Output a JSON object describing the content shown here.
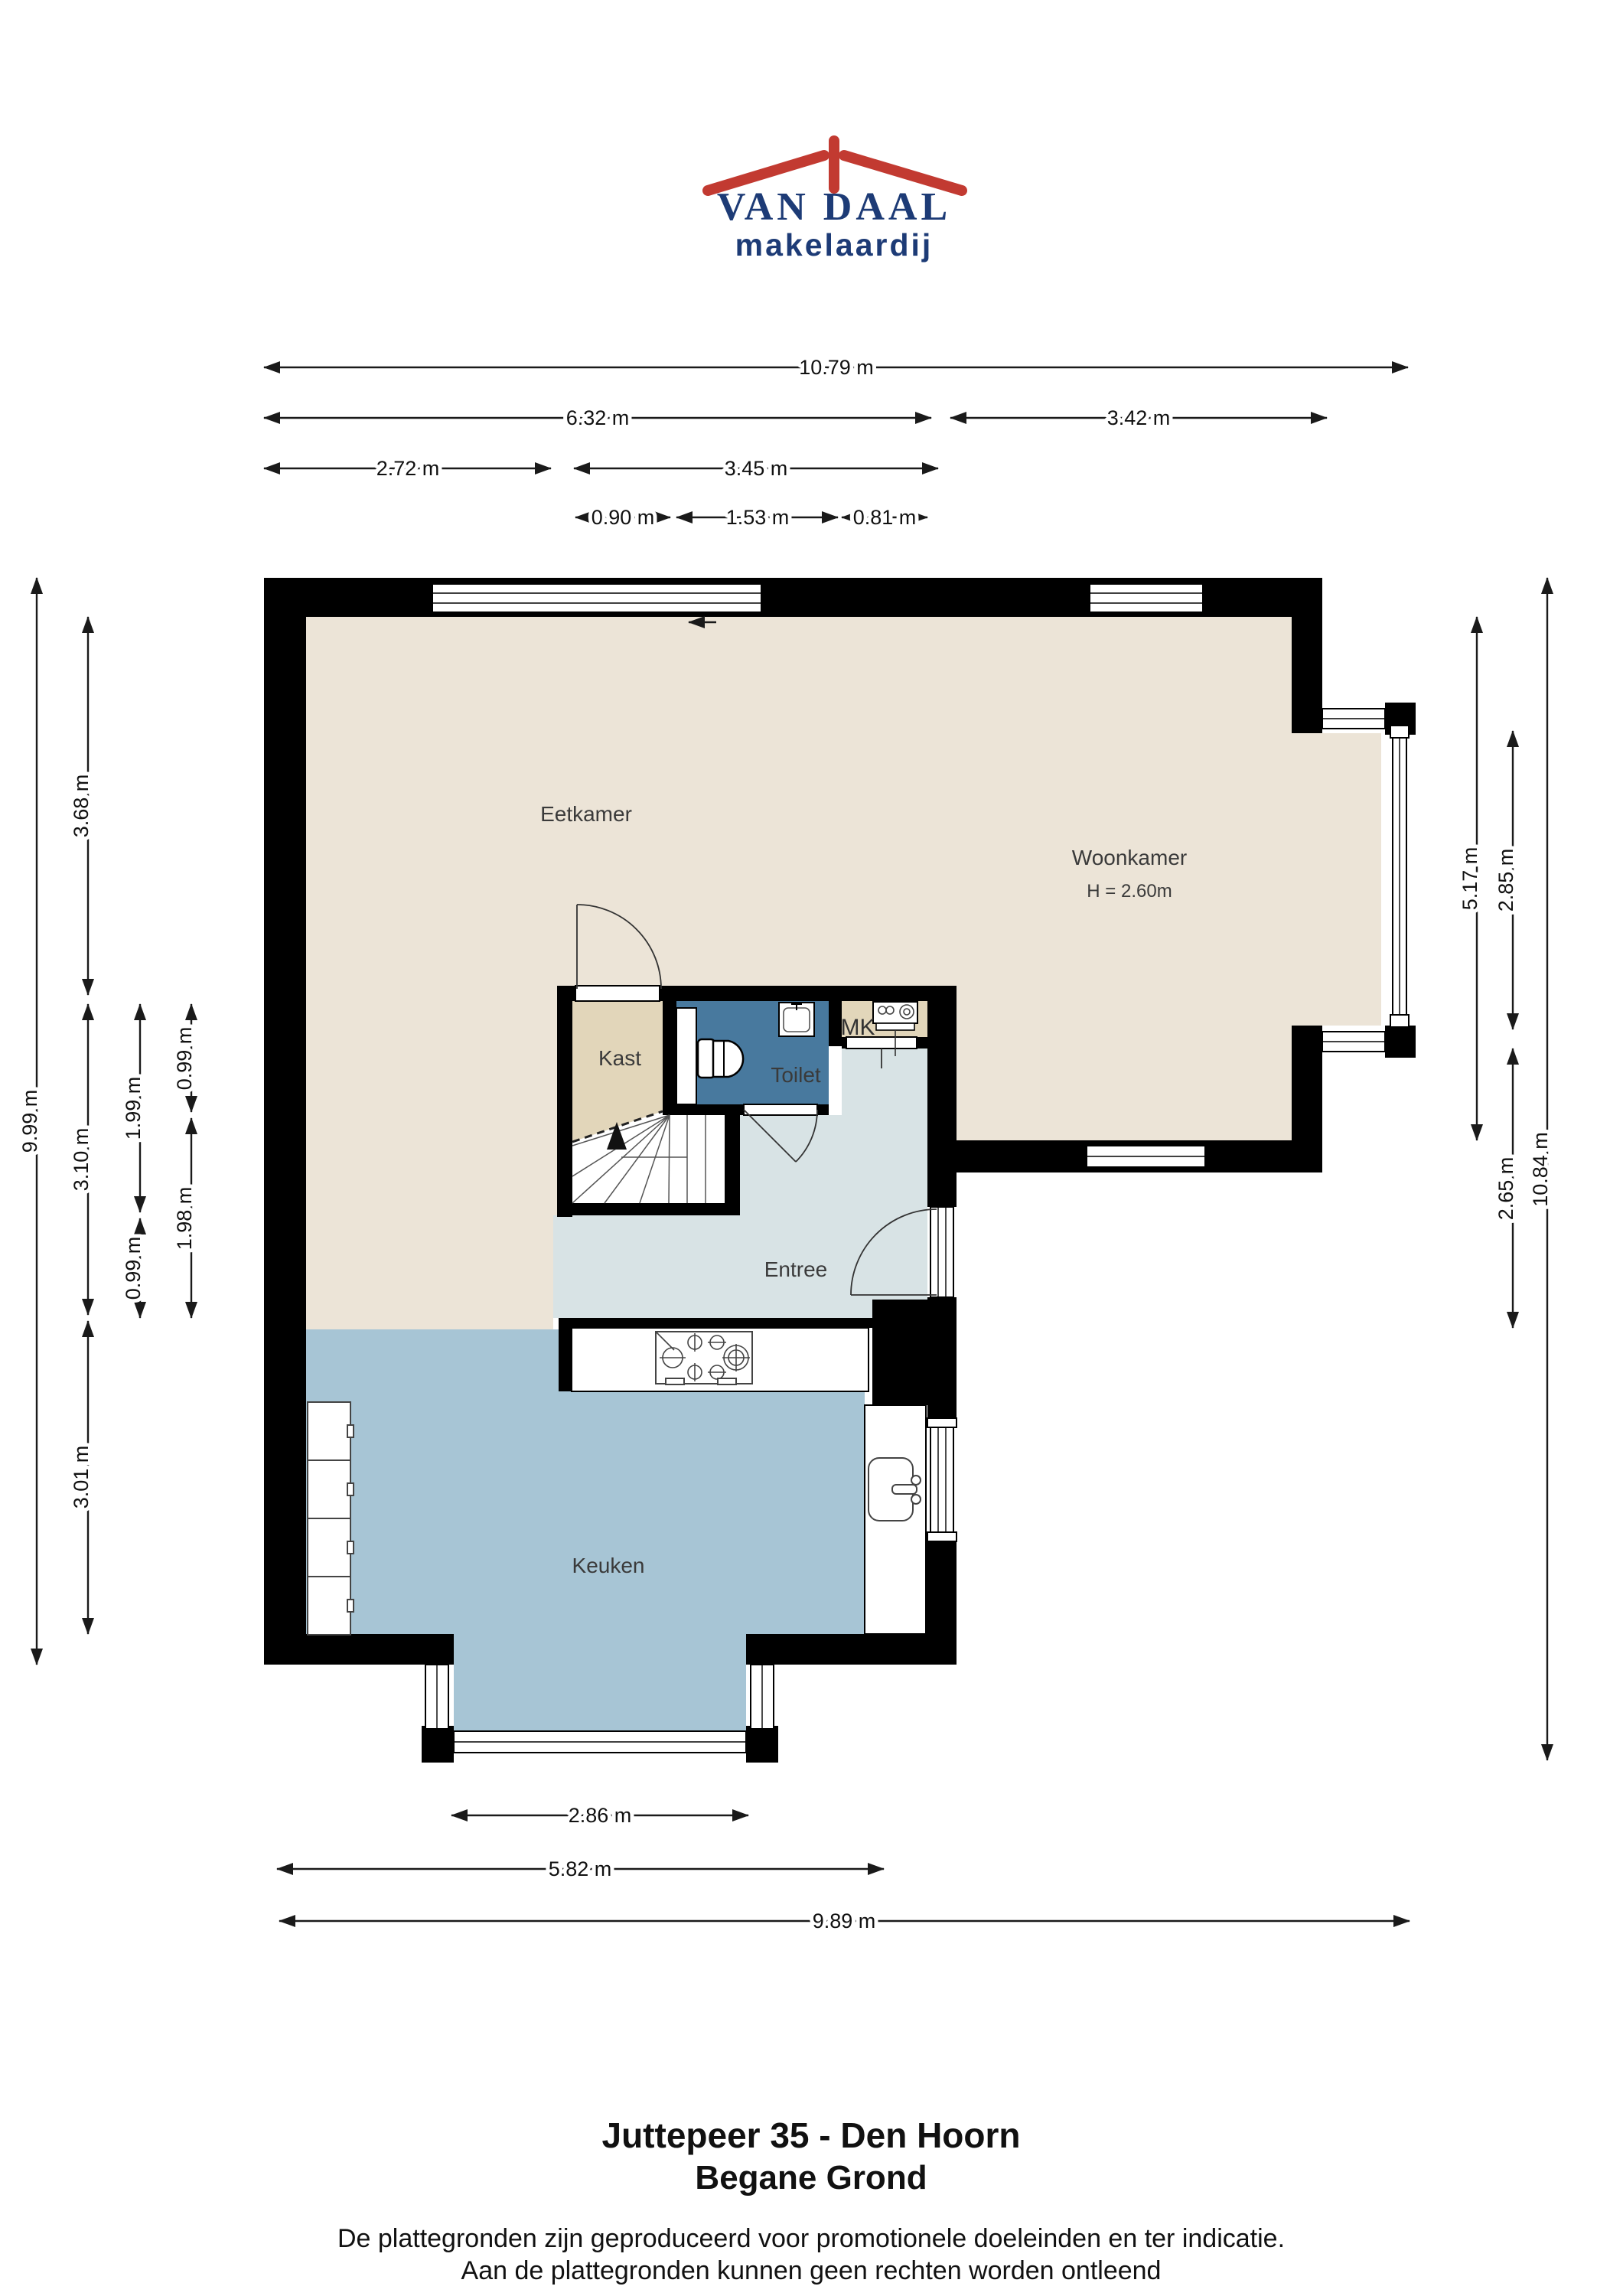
{
  "logo": {
    "name": "VAN DAAL",
    "subtitle": "makelaardij",
    "roof_color": "#c23a31",
    "text_color": "#1d3b76"
  },
  "titles": {
    "address": "Juttepeer 35 - Den Hoorn",
    "floor": "Begane Grond",
    "disclaimer_line1": "De plattegronden zijn geproduceerd voor promotionele doeleinden en ter indicatie.",
    "disclaimer_line2": "Aan de plattegronden kunnen geen rechten worden ontleend"
  },
  "rooms": {
    "eetkamer": "Eetkamer",
    "woonkamer": "Woonkamer",
    "woonkamer_ceiling": "H = 2.60m",
    "kast": "Kast",
    "toilet": "Toilet",
    "meterkast": "MK",
    "entree": "Entree",
    "keuken": "Keuken"
  },
  "dims": {
    "d_10_79": "10.79 m",
    "d_6_32": "6.32 m",
    "d_3_42": "3.42 m",
    "d_2_72": "2.72 m",
    "d_3_45": "3.45 m",
    "d_0_90": "0.90 m",
    "d_1_53": "1.53 m",
    "d_0_81": "0.81 m",
    "d_9_99": "9.99 m",
    "d_3_68": "3.68 m",
    "d_3_10": "3.10 m",
    "d_3_01": "3.01 m",
    "d_1_99": "1.99 m",
    "d_0_99a": "0.99 m",
    "d_0_99b": "0.99 m",
    "d_1_98": "1.98 m",
    "d_5_17": "5.17 m",
    "d_2_85": "2.85 m",
    "d_2_65": "2.65 m",
    "d_10_84": "10.84 m",
    "d_2_86": "2.86 m",
    "d_5_82": "5.82 m",
    "d_9_89": "9.89 m"
  },
  "colors": {
    "wall": "#000000",
    "living_floor": "#ece4d7",
    "closet_floor": "#e2d6ba",
    "toilet_floor": "#48799e",
    "hall_floor": "#d8e3e5",
    "kitchen_floor": "#a7c5d5"
  }
}
